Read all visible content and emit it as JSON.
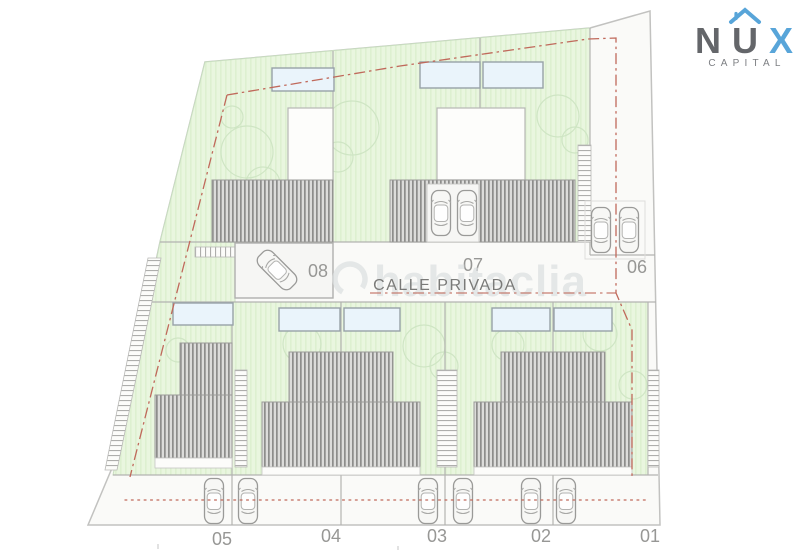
{
  "logo": {
    "letter_n": "N",
    "letter_u": "U",
    "letter_x": "X",
    "subtitle": "CAPITAL",
    "gray": "#64666a",
    "blue": "#58a5d9"
  },
  "plan": {
    "street_label": "CALLE PRIVADA",
    "watermark": "habitaclia",
    "plot_labels": {
      "p1": "01",
      "p2": "02",
      "p3": "03",
      "p4": "04",
      "p5": "05",
      "p6": "06",
      "p7": "07",
      "p8": "08"
    },
    "colors": {
      "garden_green": "#e9f6df",
      "garden_stripe": "#ddf0d0",
      "roof_gray": "#8d8d8b",
      "pool_blue": "#eaf4fb",
      "boundary_red": "#c0695b",
      "outline_gray": "#c2c2c0",
      "label_gray": "#979795"
    }
  }
}
